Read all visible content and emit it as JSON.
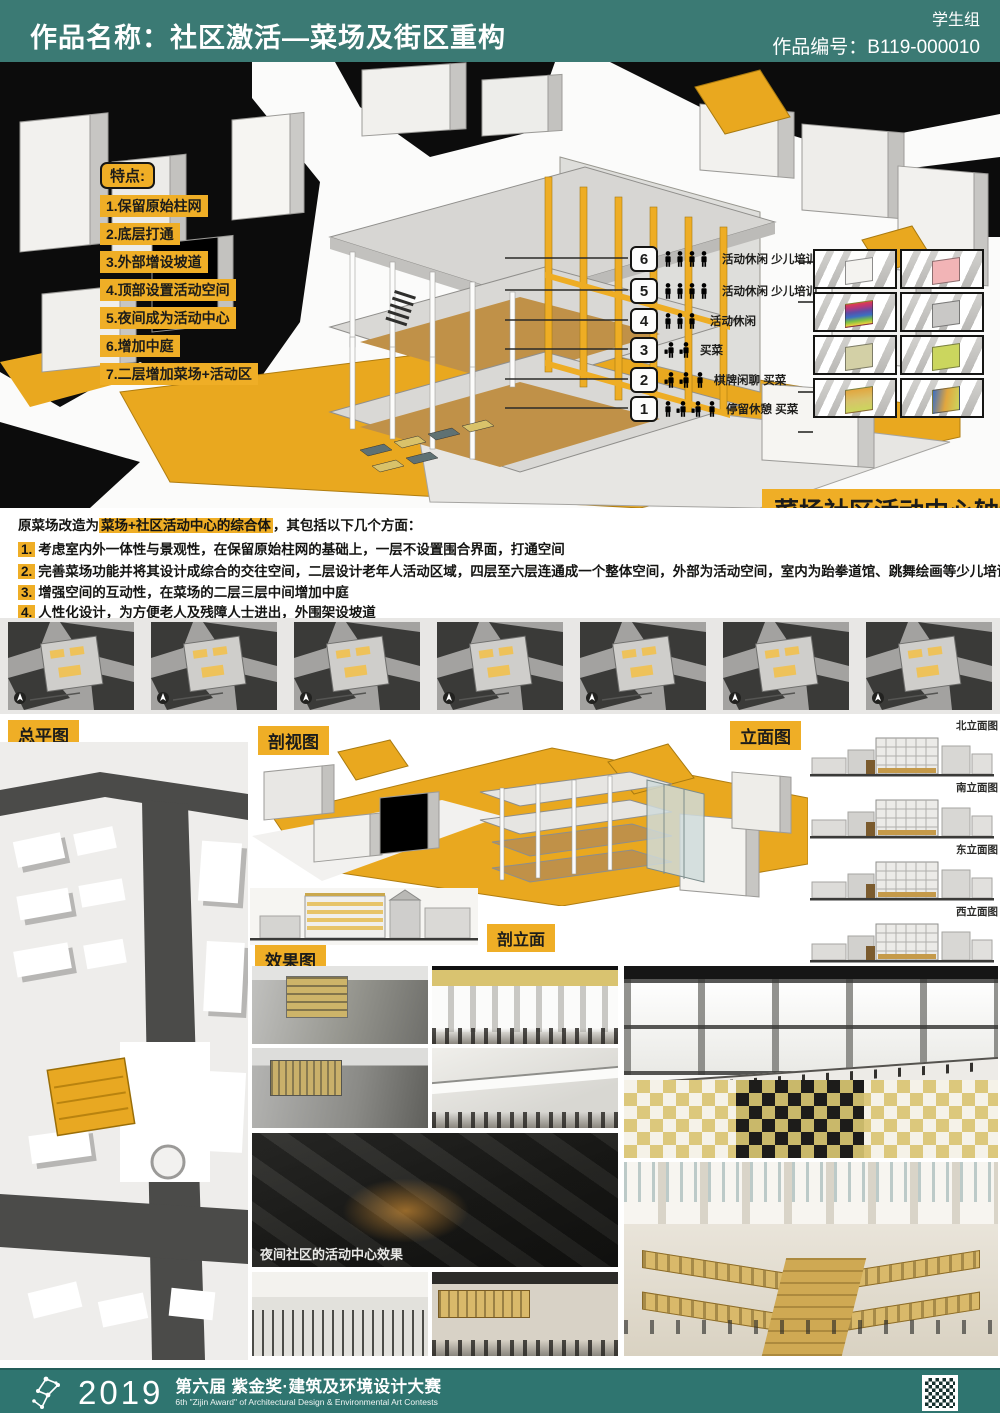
{
  "header": {
    "title": "作品名称：社区激活—菜场及街区重构",
    "group": "学生组",
    "entry_no": "作品编号：B119-000010"
  },
  "features": {
    "title": "特点:",
    "items": [
      "1.保留原始柱网",
      "2.底层打通",
      "3.外部增设坡道",
      "4.顶部设置活动空间",
      "5.夜间成为活动中心",
      "6.增加中庭",
      "7.二层增加菜场+活动区"
    ]
  },
  "floors": [
    {
      "num": "6",
      "label": "活动休闲 少儿培训"
    },
    {
      "num": "5",
      "label": "活动休闲 少儿培训"
    },
    {
      "num": "4",
      "label": "活动休闲"
    },
    {
      "num": "3",
      "label": "买菜"
    },
    {
      "num": "2",
      "label": "棋牌闲聊 买菜"
    },
    {
      "num": "1",
      "label": "停留休憩 买菜"
    }
  ],
  "axon_title": "菜场社区活动中心轴测图",
  "thumbnails": {
    "highlights": [
      "none",
      "pink",
      "rainbow-stack",
      "gray-wireframe",
      "pale-green",
      "yellow-green",
      "orange-stack",
      "multicolor"
    ]
  },
  "description": {
    "intro_pre": "原菜场改造为",
    "intro_highlight": "菜场+社区活动中心的综合体",
    "intro_post": "，其包括以下几个方面：",
    "points": [
      {
        "num": "1.",
        "text": "考虑室内外一体性与景观性，在保留原始柱网的基础上，一层不设置围合界面，打通空间"
      },
      {
        "num": "2.",
        "text": "完善菜场功能并将其设计成综合的交往空间，二层设计老年人活动区域，四层至六层连通成一个整体空间，外部为活动空间，室内为跆拳道馆、跳舞绘画等少儿培训班"
      },
      {
        "num": "3.",
        "text": "增强空间的互动性，在菜场的二层三层中间增加中庭"
      },
      {
        "num": "4.",
        "text": "人性化设计，为方便老人及残障人士进出，外围架设坡道"
      }
    ]
  },
  "section_labels": {
    "site_plan": "总平图",
    "section_view": "剖视图",
    "elevations": "立面图",
    "section_elevation": "剖立面",
    "renderings": "效果图"
  },
  "elevations": [
    "北立面图",
    "南立面图",
    "东立面图",
    "西立面图"
  ],
  "night_caption": "夜间社区的活动中心效果",
  "footer": {
    "year": "2019",
    "title_cn": "第六届 紫金奖·建筑及环境设计大赛",
    "title_en": "6th \"Zijin Award\" of Architectural Design & Environmental Art Contests"
  },
  "colors": {
    "accent_yellow": "#efae26",
    "header_teal": "#3b7a74",
    "footer_teal": "#2f7570",
    "panel_black": "#0c0c0c",
    "ochre_floor": "#c09148"
  }
}
